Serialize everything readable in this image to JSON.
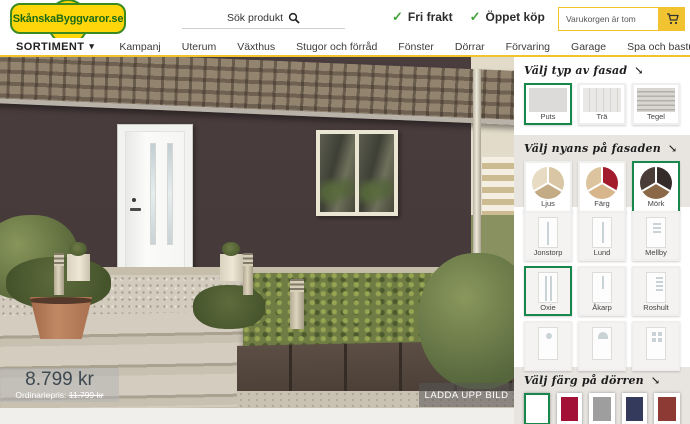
{
  "icons": {
    "check": "✓",
    "chevron_down": "▾",
    "arrow": "↘"
  },
  "accent": {
    "selected_green": "#17874b",
    "brand_yellow": "#f2c330",
    "facade_brown": "#46393a"
  },
  "header": {
    "logo_text": "SkånskaByggvaror.se",
    "search": {
      "placeholder": "Sök produkt"
    },
    "benefits": [
      {
        "label": "Fri frakt"
      },
      {
        "label": "Öppet köp"
      }
    ],
    "cart": {
      "status_text": "Varukorgen är tom"
    }
  },
  "nav": {
    "sortiment_label": "SORTIMENT",
    "items": [
      "Kampanj",
      "Uterum",
      "Växthus",
      "Stugor och förråd",
      "Fönster",
      "Dörrar",
      "Förvaring",
      "Garage",
      "Spa och bastu",
      "Markiser",
      "Badrum"
    ]
  },
  "visualizer": {
    "price": {
      "current": "8.799 kr",
      "ordinary_label": "Ordinariepris:",
      "ordinary_price": "11.799 kr"
    },
    "upload_button": "LADDA UPP BILD"
  },
  "sidebar": {
    "facade_type": {
      "title": "Välj typ av fasad",
      "options": [
        {
          "label": "Puts",
          "selected": true
        },
        {
          "label": "Trä",
          "selected": false
        },
        {
          "label": "Tegel",
          "selected": false
        }
      ]
    },
    "facade_shade": {
      "title": "Välj nyans på fasaden",
      "options": [
        {
          "label": "Ljus",
          "selected": false,
          "colors": [
            "#e7dcc3",
            "#d8c6a4",
            "#c3ac85"
          ]
        },
        {
          "label": "Färg",
          "selected": false,
          "colors": [
            "#dcc59e",
            "#a31c2e",
            "#d8b68b"
          ]
        },
        {
          "label": "Mörk",
          "selected": true,
          "colors": [
            "#4a3c37",
            "#352c29",
            "#8a6848"
          ]
        }
      ]
    },
    "door_models": {
      "options": [
        {
          "label": "Jonstorp",
          "selected": false
        },
        {
          "label": "Lund",
          "selected": false
        },
        {
          "label": "Mellby",
          "selected": false
        },
        {
          "label": "Oxie",
          "selected": true
        },
        {
          "label": "Åkarp",
          "selected": false
        },
        {
          "label": "Roshult",
          "selected": false
        },
        {
          "label": "",
          "selected": false
        },
        {
          "label": "",
          "selected": false
        },
        {
          "label": "",
          "selected": false
        }
      ]
    },
    "door_color": {
      "title": "Välj färg på dörren",
      "colors": [
        "#ffffff",
        "#a31236",
        "#9e9e9e",
        "#343a5c",
        "#8c3a33"
      ],
      "selected_index": 0
    }
  }
}
